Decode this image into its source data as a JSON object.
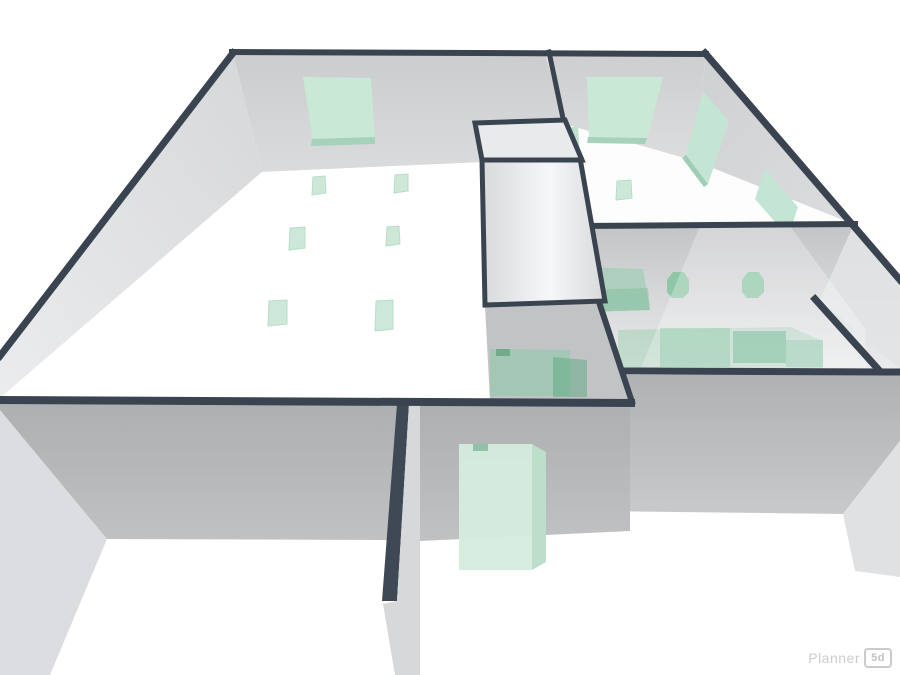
{
  "app": {
    "watermark": {
      "brand": "Planner",
      "badge": "5d"
    }
  },
  "scene": {
    "background": "#ffffff",
    "stroke_color": "#3a4450",
    "accent_green": "#c9e8d6",
    "shapes": [
      {
        "name": "left-back-wall",
        "kind": "polygon",
        "pts": "233,53 545,52 564,124 530,160 262,172",
        "fill": "url(#gBackL)"
      },
      {
        "name": "left-west-wall",
        "kind": "polygon",
        "pts": "233,53 262,172 0,398 0,357",
        "fill": "url(#gWest)"
      },
      {
        "name": "left-room-floor",
        "kind": "polygon",
        "pts": "262,172 530,160 631,401 0,399",
        "fill": "#ffffff"
      },
      {
        "name": "left-back-window",
        "kind": "polygon",
        "pts": "303,77 371,78 375,139 313,141",
        "fill": "#c9e8d6"
      },
      {
        "name": "left-back-window-sill",
        "kind": "polygon",
        "pts": "312,139 375,137 375,144 311,146",
        "fill": "#a6d2bb"
      },
      {
        "name": "floor-item-1",
        "kind": "polygon",
        "pts": "313,177 325,176 326,193 312,195",
        "fill": "#cde8d9",
        "stroke": "#b7ddc7",
        "sw": 1
      },
      {
        "name": "floor-item-2",
        "kind": "polygon",
        "pts": "395,175 408,174 408,191 394,193",
        "fill": "#cde8d9",
        "stroke": "#b7ddc7",
        "sw": 1
      },
      {
        "name": "floor-item-3",
        "kind": "polygon",
        "pts": "290,228 305,227 305,248 289,250",
        "fill": "#cde8d9",
        "stroke": "#b7ddc7",
        "sw": 1
      },
      {
        "name": "floor-item-4",
        "kind": "polygon",
        "pts": "387,227 399,226 400,244 386,246",
        "fill": "#cde8d9",
        "stroke": "#b7ddc7",
        "sw": 1
      },
      {
        "name": "floor-item-5",
        "kind": "polygon",
        "pts": "269,301 287,300 287,324 268,326",
        "fill": "#cde8d9",
        "stroke": "#b7ddc7",
        "sw": 1
      },
      {
        "name": "floor-item-6",
        "kind": "polygon",
        "pts": "376,301 393,300 393,329 375,331",
        "fill": "#cde8d9",
        "stroke": "#b7ddc7",
        "sw": 1
      },
      {
        "name": "bedroom-back-wall",
        "kind": "polygon",
        "pts": "546,53 706,54 695,161 564,124",
        "fill": "url(#gBackR)"
      },
      {
        "name": "bedroom-east-wall",
        "kind": "polygon",
        "pts": "706,54 897,276 853,224 695,161",
        "fill": "url(#gEast)"
      },
      {
        "name": "bedroom-floor",
        "kind": "polygon",
        "pts": "564,124 695,161 853,224 578,227",
        "fill": "#fdfdfe"
      },
      {
        "name": "divider-window-sliver",
        "kind": "polygon",
        "pts": "568,128 578,126 580,158 570,160",
        "fill": "#bfe0cf"
      },
      {
        "name": "bedroom-back-window",
        "kind": "polygon",
        "pts": "587,77 663,77 647,140 589,139",
        "fill": "#c9e8d6"
      },
      {
        "name": "bedroom-back-window-sill",
        "kind": "polygon",
        "pts": "588,137 647,138 645,144 587,143",
        "fill": "#a6d2bb"
      },
      {
        "name": "east-window-1",
        "kind": "polygon",
        "pts": "703,91 729,121 708,184 686,155",
        "fill": "#c4e5d3"
      },
      {
        "name": "east-window-1-sill",
        "kind": "polygon",
        "pts": "686,155 708,184 704,187 682,158",
        "fill": "#9fceb6"
      },
      {
        "name": "east-window-2",
        "kind": "polygon",
        "pts": "765,169 798,207 788,237 755,199",
        "fill": "#c4e5d3"
      },
      {
        "name": "bedroom-floor-item",
        "kind": "polygon",
        "pts": "617,181 631,180 632,198 616,200",
        "fill": "#cde8d9",
        "stroke": "#b7ddc7",
        "sw": 1
      },
      {
        "name": "room-divider-top-edge",
        "kind": "line",
        "pts": "549,52 564,123",
        "sw": 5
      },
      {
        "name": "right-rooms-band",
        "kind": "polygon",
        "pts": "578,228 853,224 900,281 900,370 625,372",
        "fill": "url(#gBand)"
      },
      {
        "name": "nook-wall-face",
        "kind": "polygon",
        "pts": "853,226 900,282 900,369 820,300",
        "fill": "#e2e3e5",
        "opacity": 0.9
      },
      {
        "name": "green-cabinet",
        "kind": "polygon",
        "pts": "578,267 643,269 650,310 585,312",
        "fill": "rgba(150,205,175,0.6)"
      },
      {
        "name": "green-cabinet-face",
        "kind": "polygon",
        "pts": "585,290 648,288 650,310 585,312",
        "fill": "rgba(110,180,142,0.35)"
      },
      {
        "name": "wall-item-1",
        "kind": "polygon",
        "pts": "667,280 673,272 684,272 689,280 689,292 683,298 672,298 667,292",
        "fill": "rgba(125,195,155,0.8)"
      },
      {
        "name": "wall-item-2",
        "kind": "polygon",
        "pts": "742,280 748,272 759,272 764,280 764,292 758,298 747,298 742,292",
        "fill": "rgba(125,195,155,0.8)"
      },
      {
        "name": "green-rug",
        "kind": "polygon",
        "pts": "618,330 790,327 823,341 823,368 618,369",
        "fill": "rgba(156,205,175,0.5)"
      },
      {
        "name": "green-sofa",
        "kind": "polygon",
        "pts": "660,328 730,328 730,367 660,367",
        "fill": "rgba(110,185,145,0.5)"
      },
      {
        "name": "green-table",
        "kind": "polygon",
        "pts": "733,331 786,331 786,363 733,363",
        "fill": "rgba(80,168,125,0.55)"
      },
      {
        "name": "green-chair",
        "kind": "polygon",
        "pts": "786,340 823,340 823,367 786,367",
        "fill": "rgba(110,185,145,0.4)"
      },
      {
        "name": "glass-overlay",
        "kind": "polygon",
        "pts": "700,226 790,226 866,330 866,370 640,370",
        "fill": "rgba(255,255,255,0.28)"
      },
      {
        "name": "bedroom-divider-edge",
        "kind": "line",
        "pts": "578,226 855,224",
        "sw": 6
      },
      {
        "name": "east-wall-top-edge",
        "kind": "line",
        "pts": "705,53 900,280",
        "sw": 7
      },
      {
        "name": "short-wall-top-edge",
        "kind": "line",
        "pts": "815,299 878,369",
        "sw": 7
      },
      {
        "name": "front-right-wall",
        "kind": "polygon",
        "pts": "625,375 900,374 900,441 843,514 589,511",
        "fill": "url(#gSouthR)"
      },
      {
        "name": "front-right-wall-top-edge",
        "kind": "line",
        "pts": "625,371 900,372",
        "sw": 7
      },
      {
        "name": "right-corner-wedge",
        "kind": "polygon",
        "pts": "900,441 900,577 855,571 843,514",
        "fill": "#e0e1e3"
      },
      {
        "name": "middle-divider-wall",
        "kind": "polygon",
        "pts": "485,305 601,301 631,401 490,401",
        "fill": "#c2c3c5"
      },
      {
        "name": "middle-door-green",
        "kind": "polygon",
        "pts": "490,349 570,350 570,396 490,396",
        "fill": "rgba(140,200,165,0.55)"
      },
      {
        "name": "middle-door-green-dark",
        "kind": "polygon",
        "pts": "553,357 587,360 587,397 553,397",
        "fill": "rgba(90,170,130,0.5)"
      },
      {
        "name": "middle-door-notch",
        "kind": "polygon",
        "pts": "496,349 510,349 510,356 496,356",
        "fill": "rgba(90,160,120,0.7)"
      },
      {
        "name": "middle-divider-edge",
        "kind": "line",
        "pts": "599,302 632,402",
        "sw": 6
      },
      {
        "name": "closet-front-wall",
        "kind": "polygon",
        "pts": "482,160 580,158 605,301 485,305",
        "fill": "url(#gCloset)",
        "stroke": "dark",
        "sw": 5
      },
      {
        "name": "closet-top",
        "kind": "polygon",
        "pts": "475,123 565,120 582,160 482,160",
        "fill": "#e9eaec",
        "stroke": "dark",
        "sw": 5
      },
      {
        "name": "back-wall-top-edge",
        "kind": "line",
        "pts": "232,52 706,54",
        "sw": 6
      },
      {
        "name": "west-wall-top-edge",
        "kind": "line",
        "pts": "233,53 0,356",
        "sw": 7
      },
      {
        "name": "front-left-wall",
        "kind": "polygon",
        "pts": "0,404 397,404 390,540 107,539 0,417",
        "fill": "url(#gSouthL)"
      },
      {
        "name": "front-mid-wall",
        "kind": "polygon",
        "pts": "420,404 630,405 630,531 420,541",
        "fill": "url(#gSouthL)"
      },
      {
        "name": "door-jamb-dark",
        "kind": "polygon",
        "pts": "397,404 409,404 397,601 382,601",
        "fill": "#3f4955"
      },
      {
        "name": "door-jamb-face",
        "kind": "polygon",
        "pts": "409,404 420,404 420,675 395,675 383,604 397,601",
        "fill": "#d7d8da"
      },
      {
        "name": "west-corner-wedge",
        "kind": "polygon",
        "pts": "0,410 107,539 50,675 0,675",
        "fill": "#dcdde0"
      },
      {
        "name": "front-left-wall-top-edge",
        "kind": "line",
        "pts": "0,400 631,403",
        "sw": 8
      },
      {
        "name": "green-door-box",
        "kind": "polygon",
        "pts": "459,444 532,444 532,570 459,570",
        "fill": "rgba(213,236,222,0.95)"
      },
      {
        "name": "green-door-box-side",
        "kind": "polygon",
        "pts": "532,444 546,452 546,562 532,570",
        "fill": "#bcdeca"
      },
      {
        "name": "green-door-box-top",
        "kind": "polygon",
        "pts": "473,444 488,444 488,451 473,451",
        "fill": "#8fc2a6"
      }
    ]
  }
}
